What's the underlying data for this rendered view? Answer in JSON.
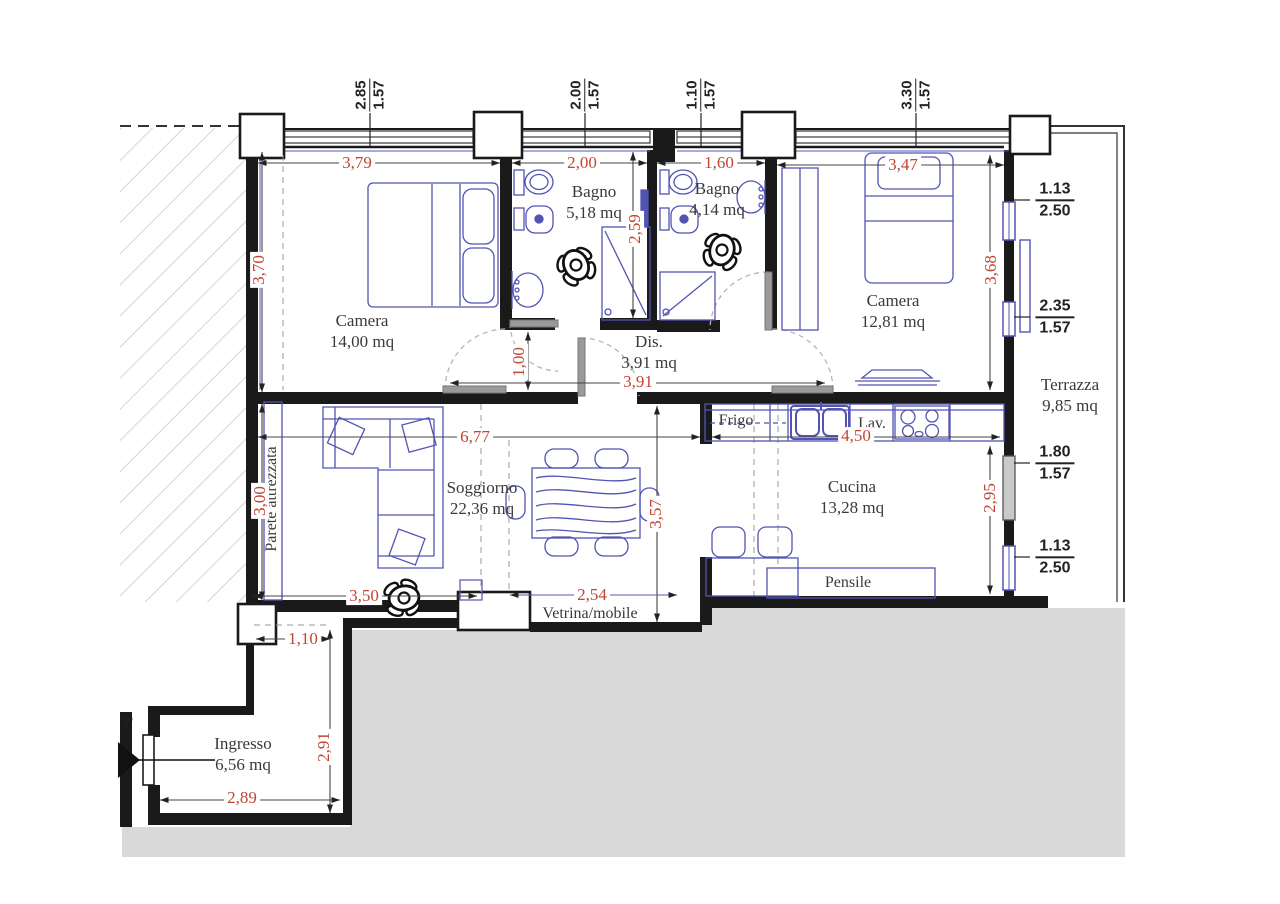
{
  "plan": {
    "rooms": [
      {
        "id": "camera1",
        "name": "Camera",
        "area": "14,00 mq"
      },
      {
        "id": "bagno1",
        "name": "Bagno",
        "area": "5,18 mq"
      },
      {
        "id": "bagno2",
        "name": "Bagno",
        "area": "4,14 mq"
      },
      {
        "id": "camera2",
        "name": "Camera",
        "area": "12,81 mq"
      },
      {
        "id": "dis",
        "name": "Dis.",
        "area": "3,91 mq"
      },
      {
        "id": "soggiorno",
        "name": "Soggiorno",
        "area": "22,36 mq"
      },
      {
        "id": "cucina",
        "name": "Cucina",
        "area": "13,28 mq"
      },
      {
        "id": "terrazza",
        "name": "Terrazza",
        "area": "9,85 mq"
      },
      {
        "id": "ingresso",
        "name": "Ingresso",
        "area": "6,56 mq"
      }
    ],
    "fixtures": {
      "fridge": "Frigo",
      "kitchen_sink": "Lav.",
      "wall_cabinet": "Pensile",
      "display_cabinet": "Vetrina/mobile",
      "equipped_wall": "Parete attrezzata",
      "edge_label": "3\""
    },
    "dimensions_red": {
      "camera1_width": "3,79",
      "bagno1_width": "2,00",
      "bagno2_width": "1,60",
      "camera2_width": "3,47",
      "camera1_height": "3,70",
      "bagno1_depth": "2,59",
      "camera2_height": "3,68",
      "dis_door": "1,00",
      "dis_width": "3,91",
      "soggiorno_width": "6,77",
      "cucina_counter": "4,50",
      "soggiorno_height": "3,00",
      "cucina_height": "2,95",
      "soggiorno_depth": "3,57",
      "soggiorno_bottom": "3,50",
      "vetrina_width": "2,54",
      "corridor_width": "1,10",
      "ingresso_height": "2,91",
      "ingresso_width": "2,89"
    },
    "window_dims_top": [
      {
        "width": "2.85",
        "height": "1.57"
      },
      {
        "width": "2.00",
        "height": "1.57"
      },
      {
        "width": "1.10",
        "height": "1.57"
      },
      {
        "width": "3.30",
        "height": "1.57"
      }
    ],
    "opening_dims_right": [
      {
        "top": "1.13",
        "bottom": "2.50"
      },
      {
        "top": "2.35",
        "bottom": "1.57"
      },
      {
        "top": "1.80",
        "bottom": "1.57"
      },
      {
        "top": "1.13",
        "bottom": "2.50"
      }
    ],
    "colors": {
      "wall": "#1a1a1a",
      "furniture_blue": "#5254b4",
      "dimension_red": "#c14434",
      "dimension_black": "#222222",
      "outside_gray": "#d9d9d9",
      "hatch_gray": "#c2c2c8",
      "door_gray": "#9a9a9a"
    }
  }
}
